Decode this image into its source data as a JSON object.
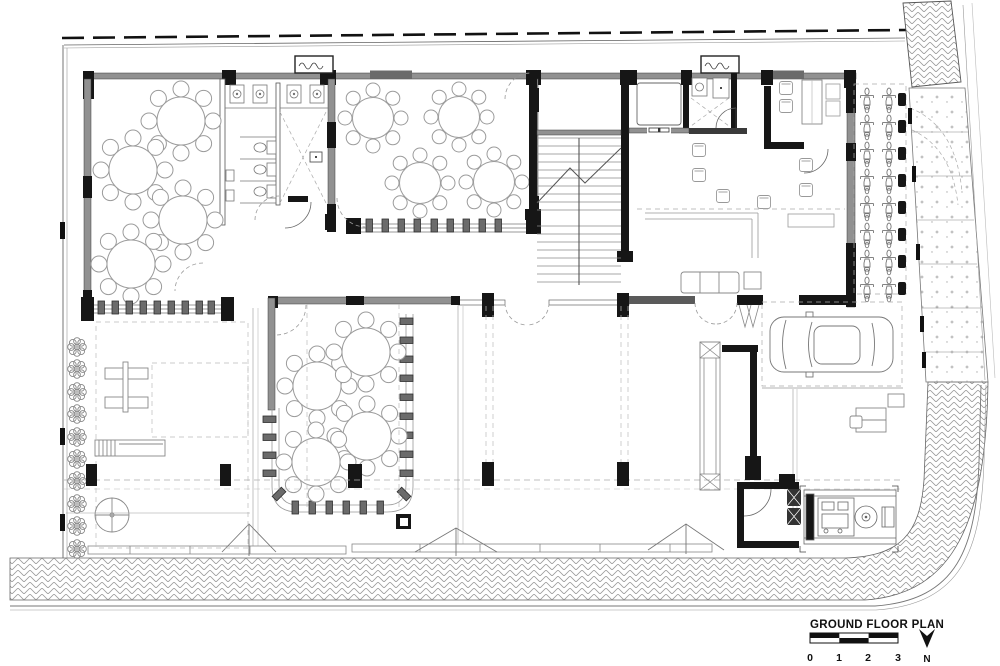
{
  "title_block": {
    "title": "GROUND FLOOR PLAN",
    "scale_labels": [
      "0",
      "1",
      "2",
      "3"
    ],
    "north_label": "N"
  },
  "colors": {
    "ink": "#161616",
    "wall_gray": "#919191",
    "dark_gray": "#5a5a5a",
    "mid_line": "#555555",
    "light_line": "#999999",
    "dash_line": "#aaaaaa",
    "paper": "#ffffff"
  }
}
